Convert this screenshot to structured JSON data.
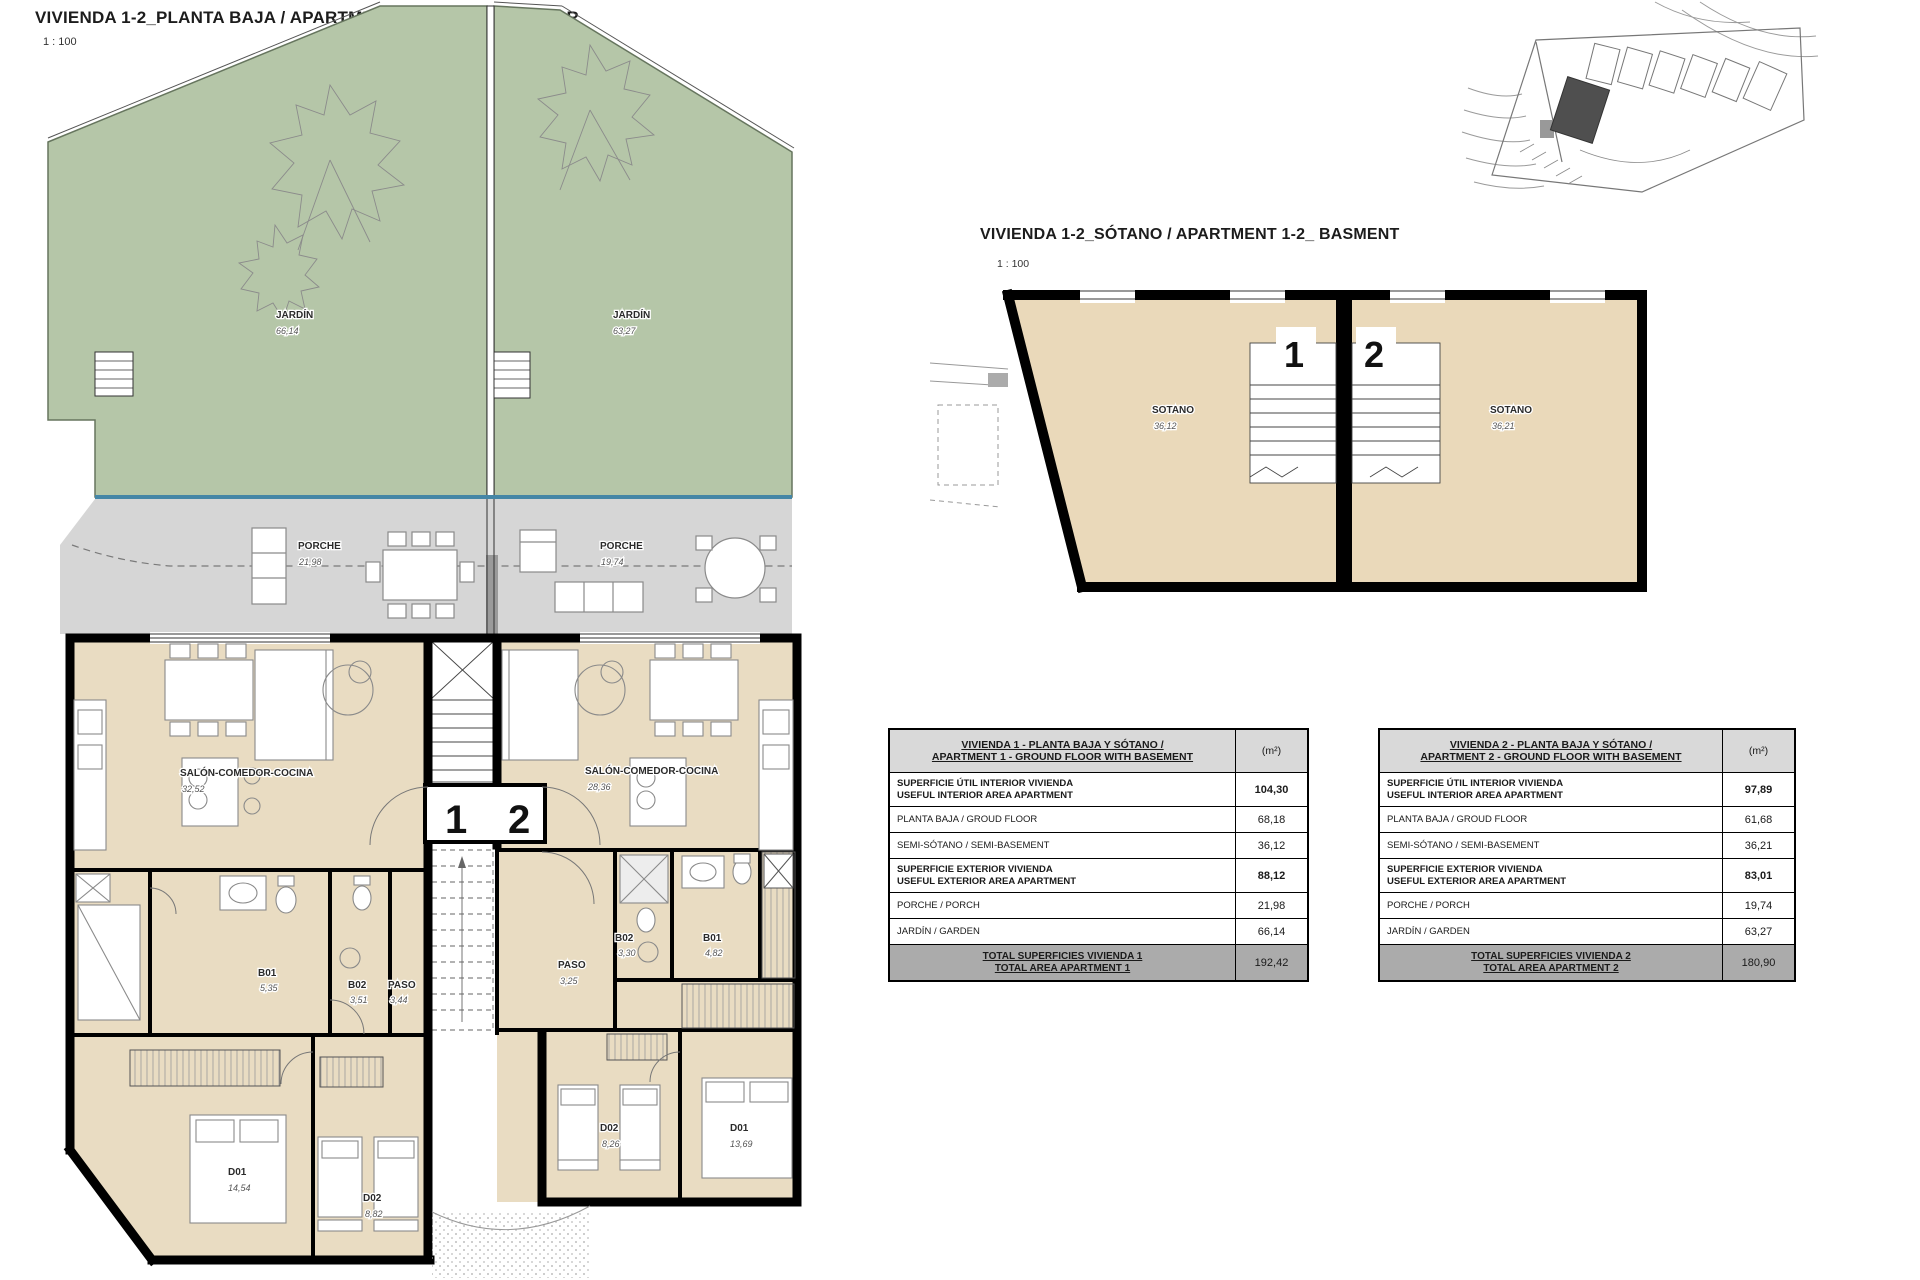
{
  "ground_floor": {
    "title": "VIVIENDA 1-2_PLANTA BAJA / APARTMENT 1-2_GROUND FLOOR",
    "scale": "1 : 100",
    "unit1_label": "1",
    "unit2_label": "2",
    "rooms": {
      "jardin1": {
        "name": "JARDÍN",
        "area": "66,14"
      },
      "jardin2": {
        "name": "JARDÍN",
        "area": "63,27"
      },
      "porche1": {
        "name": "PORCHE",
        "area": "21,98"
      },
      "porche2": {
        "name": "PORCHE",
        "area": "19,74"
      },
      "salon1": {
        "name": "SALÓN-COMEDOR-COCINA",
        "area": "32,52"
      },
      "salon2": {
        "name": "SALÓN-COMEDOR-COCINA",
        "area": "28,36"
      },
      "b01_1": {
        "name": "B01",
        "area": "5,35"
      },
      "b02_1": {
        "name": "B02",
        "area": "3,51"
      },
      "paso1": {
        "name": "PASO",
        "area": "3,44"
      },
      "paso2": {
        "name": "PASO",
        "area": "3,25"
      },
      "b02_2": {
        "name": "B02",
        "area": "3,30"
      },
      "b01_2": {
        "name": "B01",
        "area": "4,82"
      },
      "d01_1": {
        "name": "D01",
        "area": "14,54"
      },
      "d02_1": {
        "name": "D02",
        "area": "8,82"
      },
      "d02_2": {
        "name": "D02",
        "area": "8,26"
      },
      "d01_2": {
        "name": "D01",
        "area": "13,69"
      }
    }
  },
  "basement": {
    "title": "VIVIENDA 1-2_SÓTANO  / APARTMENT 1-2_ BASMENT",
    "scale": "1 : 100",
    "unit1_label": "1",
    "unit2_label": "2",
    "rooms": {
      "sotano1": {
        "name": "SOTANO",
        "area": "36,12"
      },
      "sotano2": {
        "name": "SOTANO",
        "area": "36,21"
      }
    }
  },
  "tables": [
    {
      "title_line1": "VIVIENDA 1 - PLANTA BAJA Y SÓTANO /",
      "title_line2": "APARTMENT 1 - GROUND FLOOR WITH BASEMENT",
      "unit_header": "(m²)",
      "rows": [
        {
          "es": "SUPERFICIE ÚTIL INTERIOR VIVIENDA",
          "en": "USEFUL INTERIOR AREA APARTMENT",
          "value": "104,30"
        },
        {
          "es": "PLANTA BAJA / GROUD FLOOR",
          "en": "",
          "value": "68,18"
        },
        {
          "es": "SEMI-SÓTANO / SEMI-BASEMENT",
          "en": "",
          "value": "36,12"
        },
        {
          "es": "SUPERFICIE EXTERIOR VIVIENDA",
          "en": "USEFUL EXTERIOR AREA APARTMENT",
          "value": "88,12"
        },
        {
          "es": "PORCHE / PORCH",
          "en": "",
          "value": "21,98"
        },
        {
          "es": "JARDÍN / GARDEN",
          "en": "",
          "value": "66,14"
        }
      ],
      "total_line1": "TOTAL SUPERFICIES VIVIENDA 1",
      "total_line2": "TOTAL AREA APARTMENT 1",
      "total_value": "192,42"
    },
    {
      "title_line1": "VIVIENDA 2 - PLANTA BAJA Y SÓTANO /",
      "title_line2": "APARTMENT 2 - GROUND FLOOR WITH BASEMENT",
      "unit_header": "(m²)",
      "rows": [
        {
          "es": "SUPERFICIE ÚTIL INTERIOR VIVIENDA",
          "en": "USEFUL INTERIOR AREA APARTMENT",
          "value": "97,89"
        },
        {
          "es": "PLANTA BAJA / GROUD FLOOR",
          "en": "",
          "value": "61,68"
        },
        {
          "es": "SEMI-SÓTANO / SEMI-BASEMENT",
          "en": "",
          "value": "36,21"
        },
        {
          "es": "SUPERFICIE EXTERIOR VIVIENDA",
          "en": "USEFUL EXTERIOR AREA APARTMENT",
          "value": "83,01"
        },
        {
          "es": "PORCHE / PORCH",
          "en": "",
          "value": "19,74"
        },
        {
          "es": "JARDÍN / GARDEN",
          "en": "",
          "value": "63,27"
        }
      ],
      "total_line1": "TOTAL SUPERFICIES VIVIENDA 2",
      "total_line2": "TOTAL AREA APARTMENT 2",
      "total_value": "180,90"
    }
  ],
  "colors": {
    "garden": "#b5c6a8",
    "porch": "#d6d6d6",
    "interior": "#e9dcc2",
    "basement_floor": "#ead9ba",
    "pool_edge_blue": "#4586a6",
    "wall": "#000000",
    "table_header_bg": "#d9d9d9",
    "table_total_bg": "#ababab"
  }
}
